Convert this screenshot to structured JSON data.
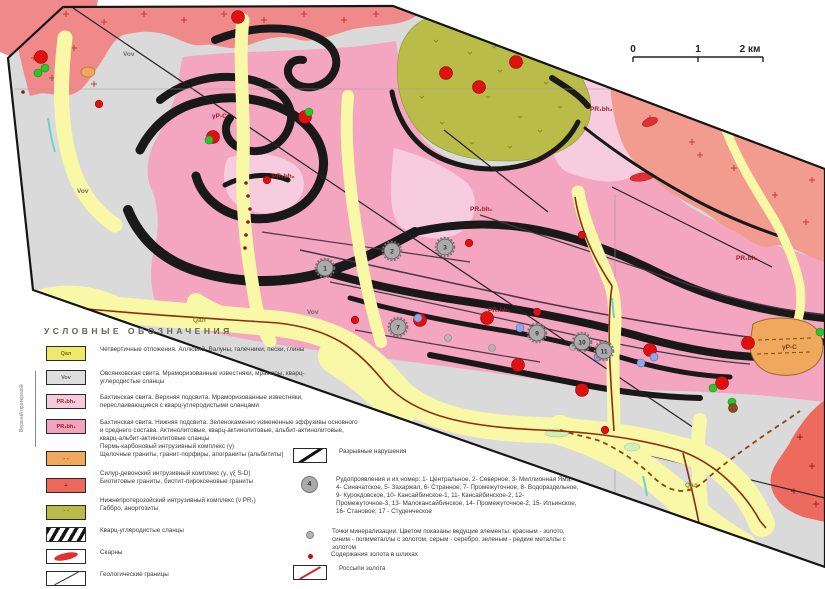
{
  "scale_bar": {
    "ticks": [
      {
        "x": 633,
        "label": "0"
      },
      {
        "x": 698,
        "label": "1"
      },
      {
        "x": 750,
        "label": "2 км"
      }
    ]
  },
  "legend": {
    "title": "УСЛОВНЫЕ ОБОЗНАЧЕНИЯ",
    "era_label": "Верхний протерозой",
    "left_rows": [
      {
        "type": "unit",
        "code": "Qал",
        "color": "#EDE96B",
        "code_color": "#77770a",
        "desc": "Четвертичные отложения. Аллювий. Валуны, галечники, пески, глины"
      },
      {
        "type": "unit",
        "code": "Vov",
        "color": "#DEDEDE",
        "code_color": "#666666",
        "desc": "Овсянковская свита. Мраморизованные известняки, мраморы, кварц-углеродистые сланцы"
      },
      {
        "type": "unit",
        "code": "PR₁bh₂",
        "color": "#F6CBDE",
        "code_color": "#9b2020",
        "desc": "Бахтинская свита. Верхняя подсвита. Мраморизованные известняки, переслаивающиеся с кварц-углеродистыми сланцами"
      },
      {
        "type": "unit",
        "code": "PR₁bh₁",
        "color": "#F3A3BF",
        "code_color": "#9b2020",
        "desc": "Бахтинская свита. Нижняя подсвита. Зеленокаменно измененные эффузивы основного и среднего состава. Актинолитовые, кварц-актинолитовые, альбит-актинолитовые, кварц-альбит-актинолитовые сланцы"
      },
      {
        "type": "heading",
        "text": "Пермь-карбоновый интрузивный комплекс (γ)"
      },
      {
        "type": "unit",
        "swatch": "orange-dashes",
        "code": "- -",
        "color": "#F0A85E",
        "code_color": "#7a4a10",
        "desc": "Щелочные граниты, гранит-порфиры, апограниты (альбититы)"
      },
      {
        "type": "heading",
        "text": "Силур-девонский интрузивный комплекс (γ, γξ S-D)"
      },
      {
        "type": "unit",
        "swatch": "red-plus",
        "code": "+",
        "color": "#ED685C",
        "code_color": "#7a1010",
        "desc": "Биотитовые граниты, биотит-пироксеновые граниты"
      },
      {
        "type": "heading",
        "text": "Нижнепротерозойский интрузивный комплекс (ν PR₁)"
      },
      {
        "type": "unit",
        "swatch": "olive-ticks",
        "code": "ˇ ˇ",
        "color": "#B9BC49",
        "code_color": "#70722a",
        "desc": "Габбро, анортозиты"
      },
      {
        "type": "unit",
        "swatch": "black-stripes",
        "code": "",
        "color": "",
        "desc": "Кварц-углеродистые сланцы"
      },
      {
        "type": "unit",
        "swatch": "skarn",
        "code": "",
        "color": "",
        "desc": "Скарны"
      },
      {
        "type": "unit",
        "swatch": "geo-line",
        "code": "",
        "color": "",
        "desc": "Геологические границы"
      }
    ],
    "right_rows": [
      {
        "swatch": "fault-line",
        "desc": "Разрывные нарушения"
      },
      {
        "swatch": "ore-circle",
        "num": "4",
        "desc": "Рудопроявления и их номер: 1- Центральное, 2- Северное, 3- Миллионная Яма, 4- Синачатское, 5- Захаржал, 6- Странное, 7- Промежуточное, 8- Водораздельное, 9- Курокдовское, 10- Кансайбинское-1, 11- Кансайбинское-2, 12- Промежуточное-3, 13- Малокансайбинское, 14- Промежуточное-2, 15- Ильинское, 16- Становое; 17 - Студенческое"
      },
      {
        "swatch": "min-dot",
        "desc": "Точки минерализации. Цветом показаны ведущие элементы: красным - золото, синим - полиметаллы с золотом, серым - серебро, зеленым - редкие металлы с золотом"
      },
      {
        "swatch": "gold-dot",
        "desc": "Содержания золота в шлихах"
      },
      {
        "swatch": "placer-line",
        "desc": "Россыпи золота"
      }
    ]
  },
  "map": {
    "labels": [
      {
        "text": "Vov",
        "x": 123,
        "y": 56,
        "color": "#6a6a6a"
      },
      {
        "text": "Vov",
        "x": 77,
        "y": 193,
        "color": "#6a6a6a"
      },
      {
        "text": "Vov",
        "x": 307,
        "y": 314,
        "color": "#6a6a6a"
      },
      {
        "text": "γP-C",
        "x": 212,
        "y": 118,
        "color": "#9b2020"
      },
      {
        "text": "PR₁bh₂",
        "x": 272,
        "y": 178,
        "color": "#9b2020"
      },
      {
        "text": "PR₁bh₂",
        "x": 590,
        "y": 111,
        "color": "#9b2020"
      },
      {
        "text": "PR₁bh₁",
        "x": 470,
        "y": 211,
        "color": "#9b2020"
      },
      {
        "text": "PR₁bh₁",
        "x": 736,
        "y": 260,
        "color": "#9b2020"
      },
      {
        "text": "PR₁bh₁",
        "x": 488,
        "y": 312,
        "color": "#9b2020"
      },
      {
        "text": "Qал",
        "x": 193,
        "y": 322,
        "color": "#8a8a20"
      },
      {
        "text": "Qал",
        "x": 685,
        "y": 487,
        "color": "#8a8a20"
      },
      {
        "text": "γP-C",
        "x": 782,
        "y": 349,
        "color": "#7a3a10"
      }
    ],
    "ore_circles": [
      {
        "n": "1",
        "x": 325,
        "y": 268
      },
      {
        "n": "2",
        "x": 392,
        "y": 251
      },
      {
        "n": "3",
        "x": 445,
        "y": 247
      },
      {
        "n": "7",
        "x": 398,
        "y": 327
      },
      {
        "n": "9",
        "x": 537,
        "y": 333
      },
      {
        "n": "10",
        "x": 582,
        "y": 342
      },
      {
        "n": "11",
        "x": 604,
        "y": 351
      }
    ],
    "point_colors": {
      "gold": "#E01010",
      "polymetal": "#8FA8E8",
      "silver": "#B5B5B5",
      "rare": "#2DC52D",
      "slick": "#8B1A1A",
      "brown": "#8B4A20"
    },
    "points": {
      "gold_large": [
        [
          41,
          57
        ],
        [
          238,
          17
        ],
        [
          213,
          137
        ],
        [
          305,
          117
        ],
        [
          446,
          73
        ],
        [
          479,
          87
        ],
        [
          516,
          62
        ],
        [
          420,
          320
        ],
        [
          487,
          318
        ],
        [
          518,
          365
        ],
        [
          650,
          350
        ],
        [
          748,
          343
        ],
        [
          722,
          383
        ],
        [
          582,
          390
        ]
      ],
      "gold_small": [
        [
          99,
          104
        ],
        [
          267,
          180
        ],
        [
          469,
          243
        ],
        [
          537,
          312
        ],
        [
          355,
          320
        ],
        [
          605,
          430
        ],
        [
          582,
          235
        ]
      ],
      "polymetal": [
        [
          418,
          318
        ],
        [
          520,
          328
        ],
        [
          598,
          357
        ],
        [
          641,
          363
        ],
        [
          654,
          357
        ]
      ],
      "silver": [
        [
          492,
          348
        ],
        [
          573,
          347
        ],
        [
          448,
          338
        ]
      ],
      "rare": [
        [
          45,
          68
        ],
        [
          38,
          73
        ],
        [
          209,
          140
        ],
        [
          309,
          112
        ],
        [
          713,
          388
        ],
        [
          732,
          402
        ],
        [
          820,
          332
        ]
      ],
      "brown": [
        [
          733,
          408
        ]
      ],
      "slick": [
        [
          23,
          92
        ],
        [
          246,
          183
        ],
        [
          248,
          196
        ],
        [
          250,
          209
        ],
        [
          248,
          222
        ],
        [
          246,
          235
        ],
        [
          245,
          248
        ]
      ]
    }
  }
}
